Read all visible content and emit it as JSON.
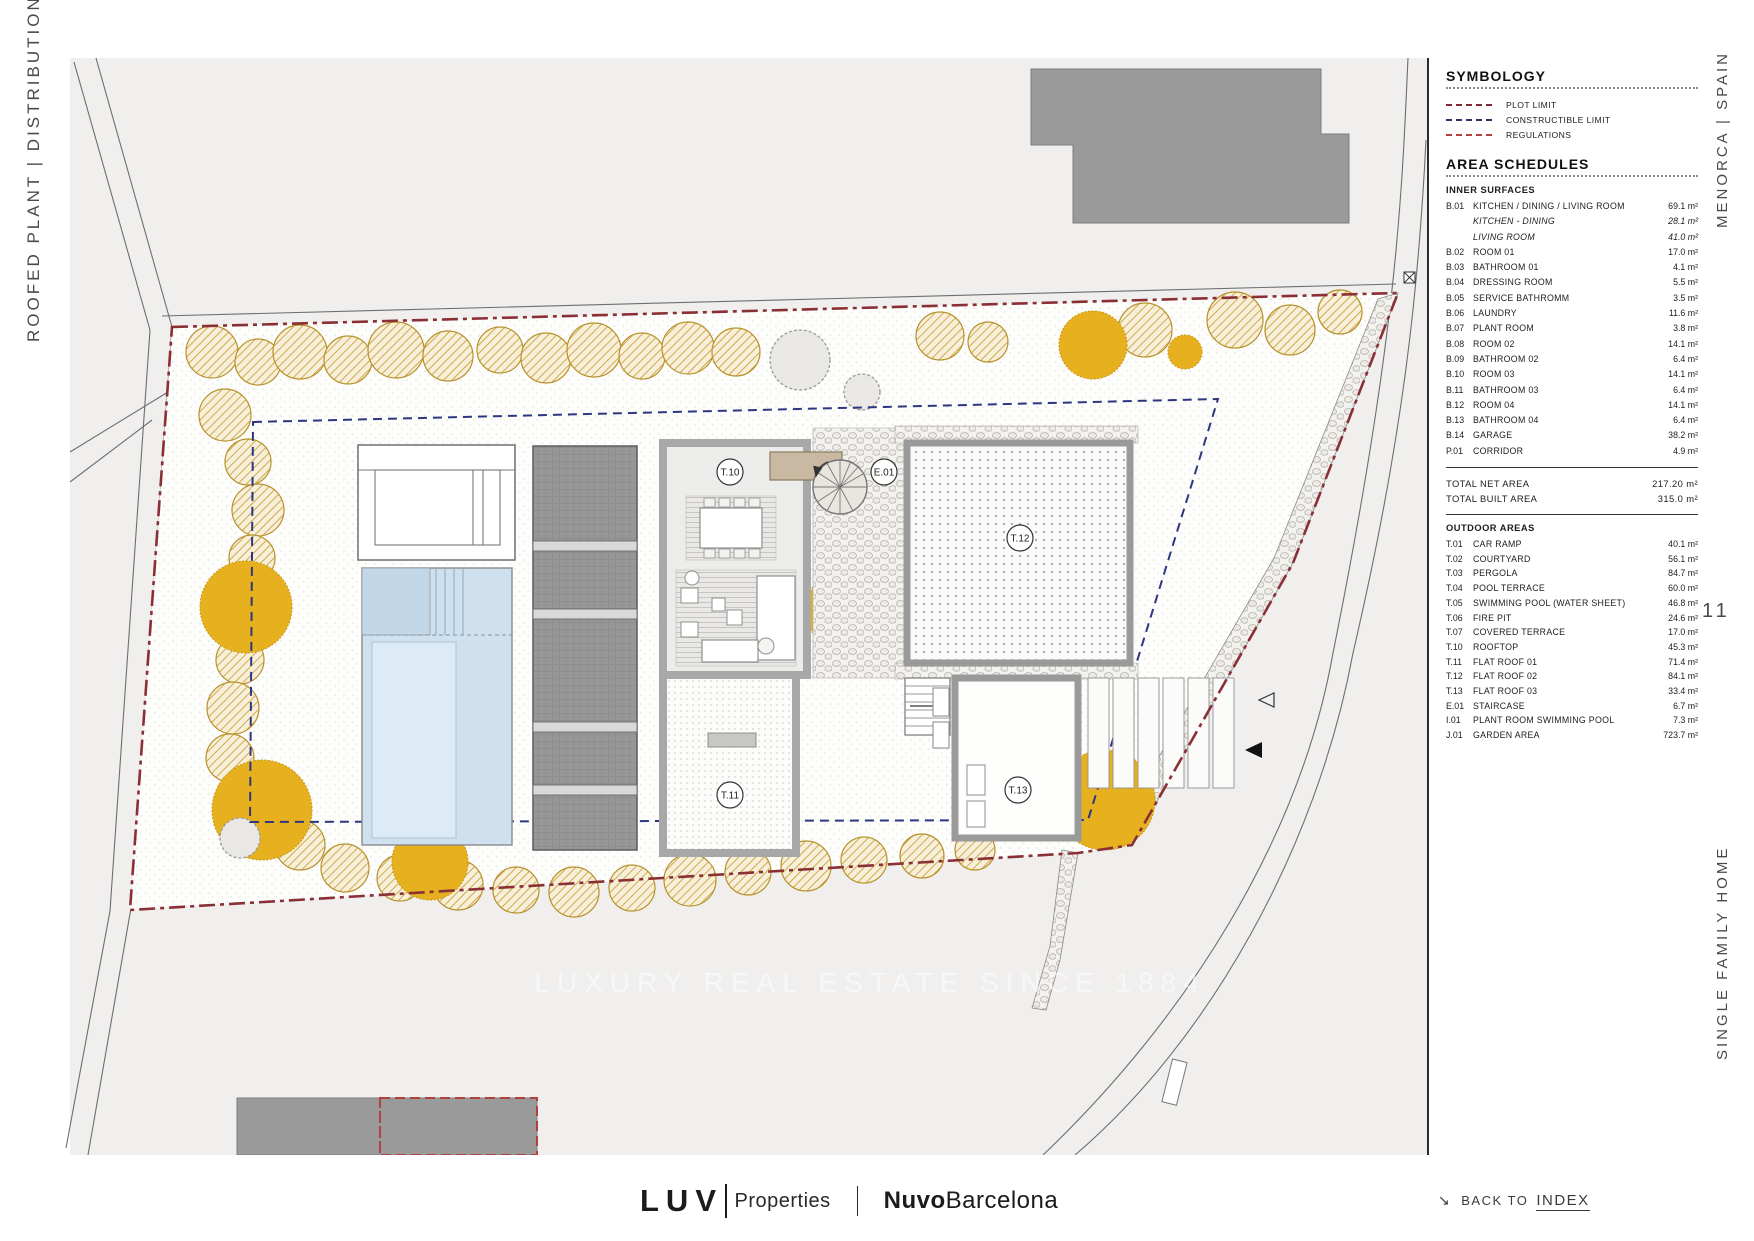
{
  "page": {
    "left_title": "ROOFED PLANT | DISTRIBUTION",
    "right_title_top": "MENORCA | SPAIN",
    "right_title_bottom": "SINGLE FAMILY HOME",
    "page_number": "11",
    "watermark": "LUXURY REAL ESTATE SINCE 1884"
  },
  "footer": {
    "brand1_bold": "LUV",
    "brand1_light": "Properties",
    "brand2_bold": "Nuvo",
    "brand2_light": "Barcelona",
    "back_arrow": "↘",
    "back_label": "BACK TO",
    "back_link": "INDEX"
  },
  "panel": {
    "unit": "m²",
    "symbology": {
      "title": "SYMBOLOGY",
      "items": [
        {
          "label": "PLOT LIMIT",
          "color": "#7b2a35"
        },
        {
          "label": "CONSTRUCTIBLE LIMIT",
          "color": "#2e3560"
        },
        {
          "label": "REGULATIONS",
          "color": "#b0413e"
        }
      ]
    },
    "area_schedules": {
      "title": "AREA SCHEDULES",
      "inner_title": "INNER SURFACES",
      "inner": [
        {
          "code": "B.01",
          "name": "KITCHEN / DINING / LIVING ROOM",
          "value": "69.1",
          "italic": false
        },
        {
          "code": "",
          "name": "KITCHEN - DINING",
          "value": "28.1",
          "italic": true
        },
        {
          "code": "",
          "name": "LIVING ROOM",
          "value": "41.0",
          "italic": true
        },
        {
          "code": "B.02",
          "name": "ROOM 01",
          "value": "17.0",
          "italic": false
        },
        {
          "code": "B.03",
          "name": "BATHROOM 01",
          "value": "4.1",
          "italic": false
        },
        {
          "code": "B.04",
          "name": "DRESSING ROOM",
          "value": "5.5",
          "italic": false
        },
        {
          "code": "B.05",
          "name": "SERVICE BATHROMM",
          "value": "3.5",
          "italic": false
        },
        {
          "code": "B.06",
          "name": "LAUNDRY",
          "value": "11.6",
          "italic": false
        },
        {
          "code": "B.07",
          "name": "PLANT ROOM",
          "value": "3.8",
          "italic": false
        },
        {
          "code": "B.08",
          "name": "ROOM 02",
          "value": "14.1",
          "italic": false
        },
        {
          "code": "B.09",
          "name": "BATHROOM 02",
          "value": "6.4",
          "italic": false
        },
        {
          "code": "B.10",
          "name": "ROOM 03",
          "value": "14.1",
          "italic": false
        },
        {
          "code": "B.11",
          "name": "BATHROOM 03",
          "value": "6.4",
          "italic": false
        },
        {
          "code": "B.12",
          "name": "ROOM 04",
          "value": "14.1",
          "italic": false
        },
        {
          "code": "B.13",
          "name": "BATHROOM 04",
          "value": "6.4",
          "italic": false
        },
        {
          "code": "B.14",
          "name": "GARAGE",
          "value": "38.2",
          "italic": false
        },
        {
          "code": "P.01",
          "name": "CORRIDOR",
          "value": "4.9",
          "italic": false
        }
      ],
      "totals": [
        {
          "name": "TOTAL NET AREA",
          "value": "217.20"
        },
        {
          "name": "TOTAL BUILT AREA",
          "value": "315.0"
        }
      ],
      "outdoor_title": "OUTDOOR AREAS",
      "outdoor": [
        {
          "code": "T.01",
          "name": "CAR RAMP",
          "value": "40.1"
        },
        {
          "code": "T.02",
          "name": "COURTYARD",
          "value": "56.1"
        },
        {
          "code": "T.03",
          "name": "PERGOLA",
          "value": "84.7"
        },
        {
          "code": "T.04",
          "name": "POOL TERRACE",
          "value": "60.0"
        },
        {
          "code": "T.05",
          "name": "SWIMMING POOL (WATER SHEET)",
          "value": "46.8"
        },
        {
          "code": "T.06",
          "name": "FIRE PIT",
          "value": "24.6"
        },
        {
          "code": "T.07",
          "name": "COVERED TERRACE",
          "value": "17.0"
        },
        {
          "code": "T.10",
          "name": "ROOFTOP",
          "value": "45.3"
        },
        {
          "code": "T.11",
          "name": "FLAT ROOF 01",
          "value": "71.4"
        },
        {
          "code": "T.12",
          "name": "FLAT ROOF 02",
          "value": "84.1"
        },
        {
          "code": "T.13",
          "name": "FLAT ROOF 03",
          "value": "33.4"
        },
        {
          "code": "E.01",
          "name": "STAIRCASE",
          "value": "6.7"
        },
        {
          "code": "I.01",
          "name": "PLANT ROOM SWIMMING POOL",
          "value": "7.3"
        },
        {
          "code": "J.01",
          "name": "GARDEN AREA",
          "value": "723.7"
        }
      ]
    }
  },
  "plan": {
    "labels": {
      "t10": "T.10",
      "t11": "T.11",
      "t12": "T.12",
      "t13": "T.13",
      "e01": "E.01"
    }
  }
}
